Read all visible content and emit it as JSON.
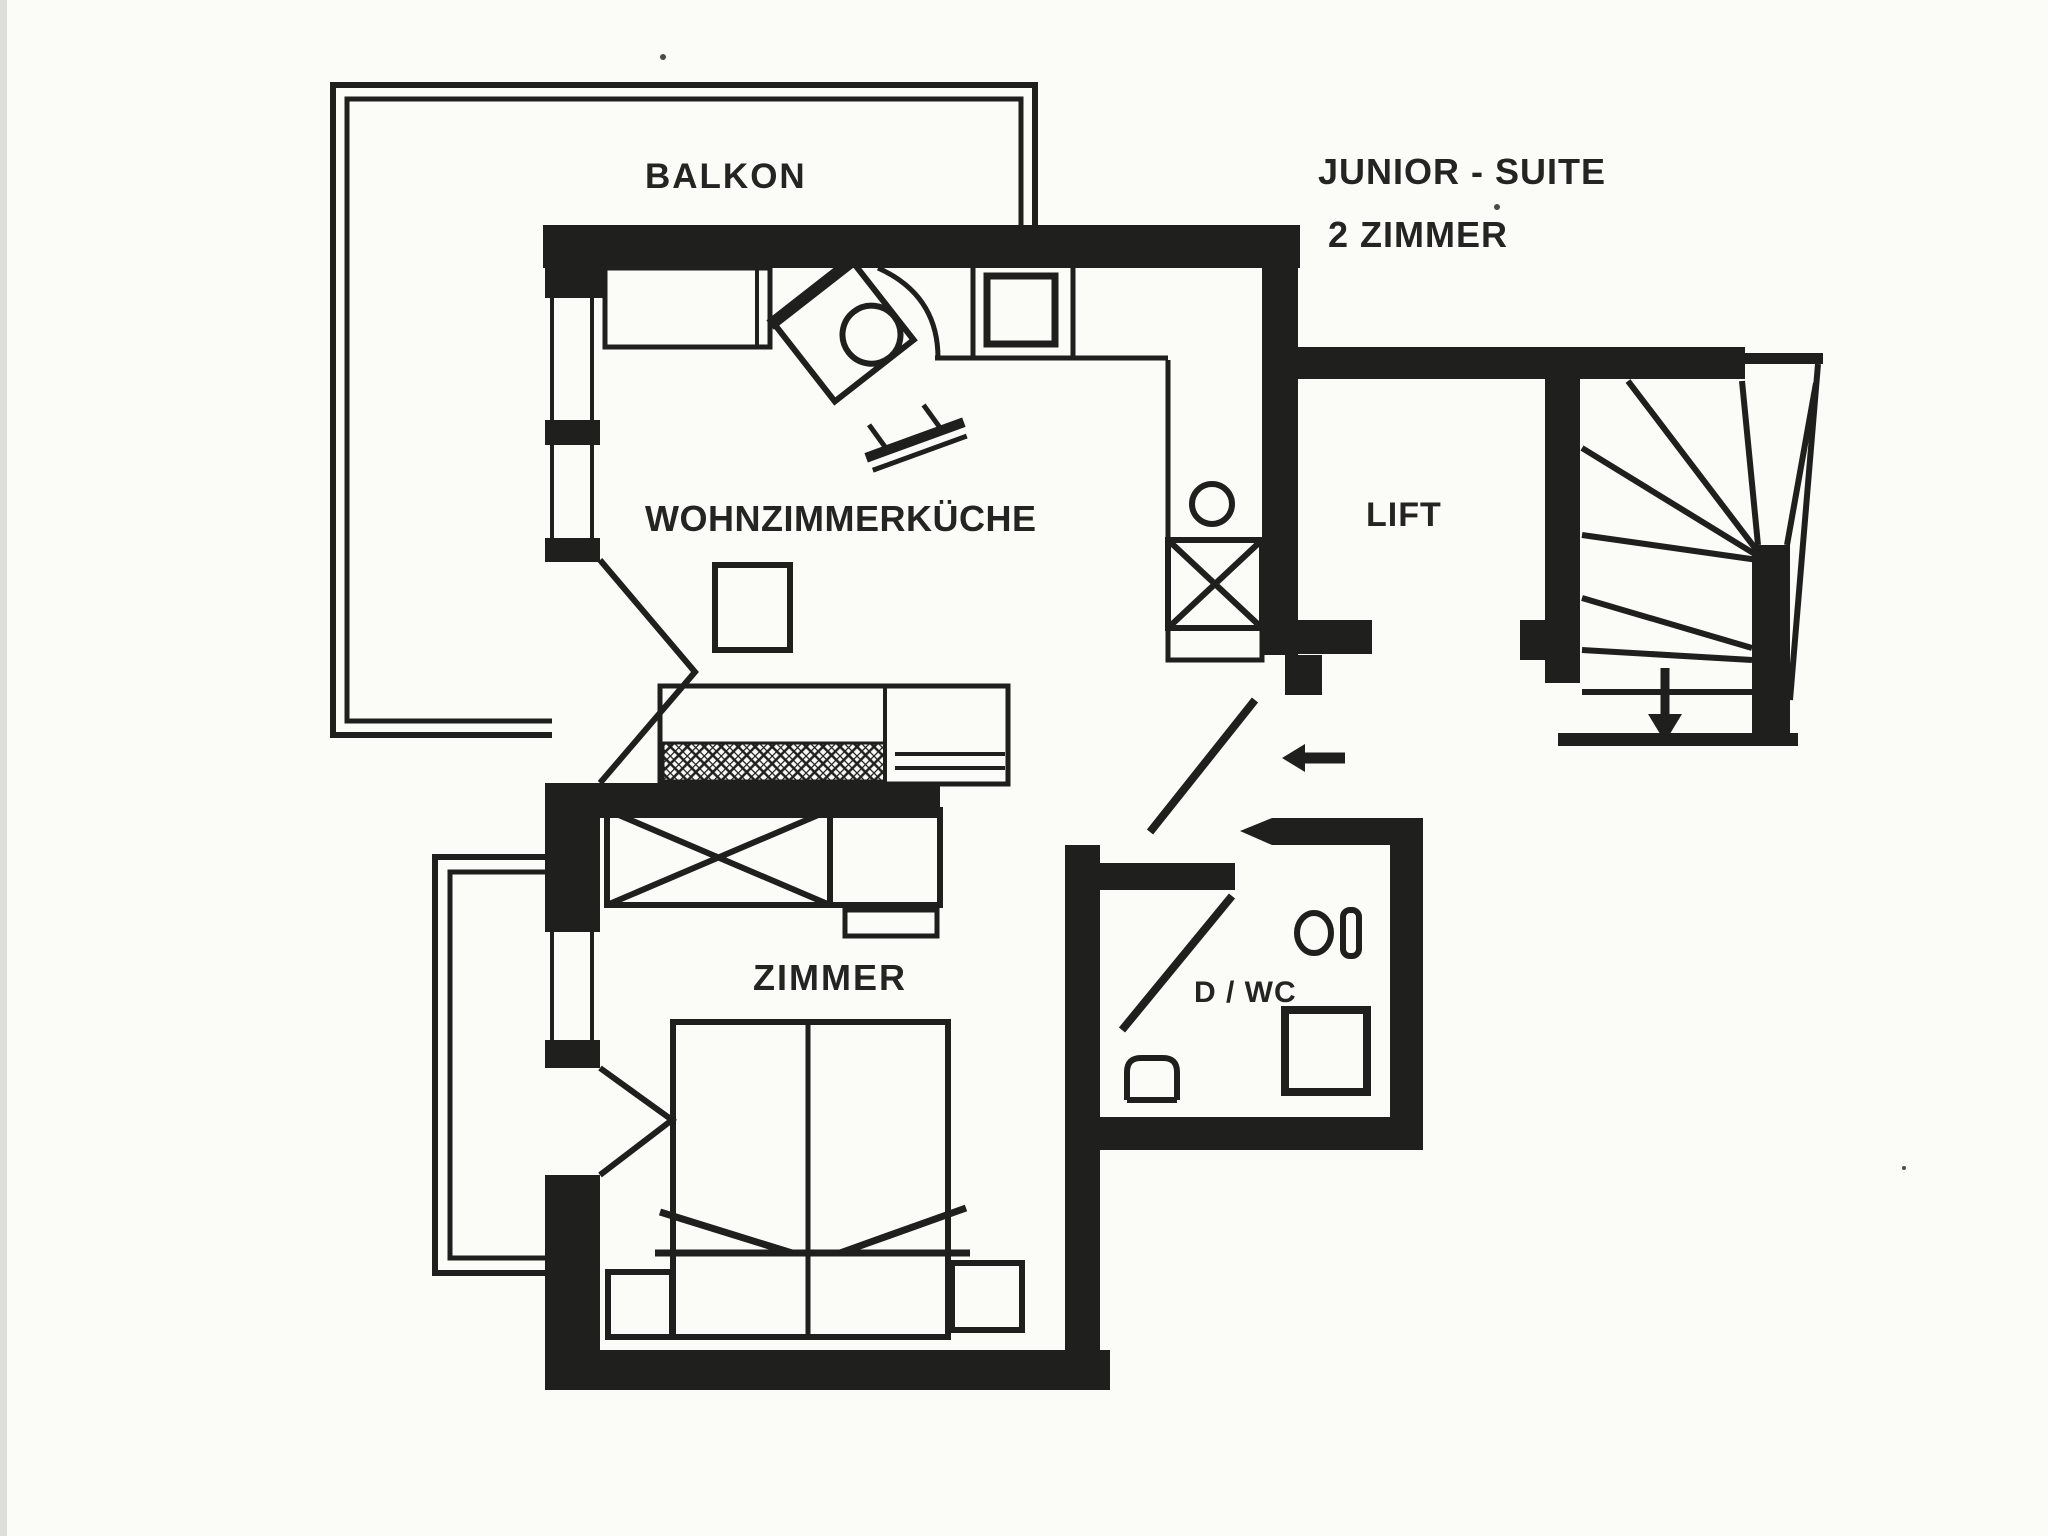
{
  "plan": {
    "suite_title": "JUNIOR - SUITE",
    "suite_subtitle": "2 ZIMMER",
    "rooms": {
      "balcony": "BALKON",
      "living_kitchen": "WOHNZIMMERKÜCHE",
      "bedroom": "ZIMMER",
      "bathroom": "D / WC",
      "lift": "LIFT"
    },
    "icons": {
      "entry_arrow": "arrow-left-entry",
      "stairs_direction": "arrow-down-stairs"
    },
    "colors": {
      "ink": "#1f1f1d",
      "paper": "#fbfbf8"
    }
  }
}
